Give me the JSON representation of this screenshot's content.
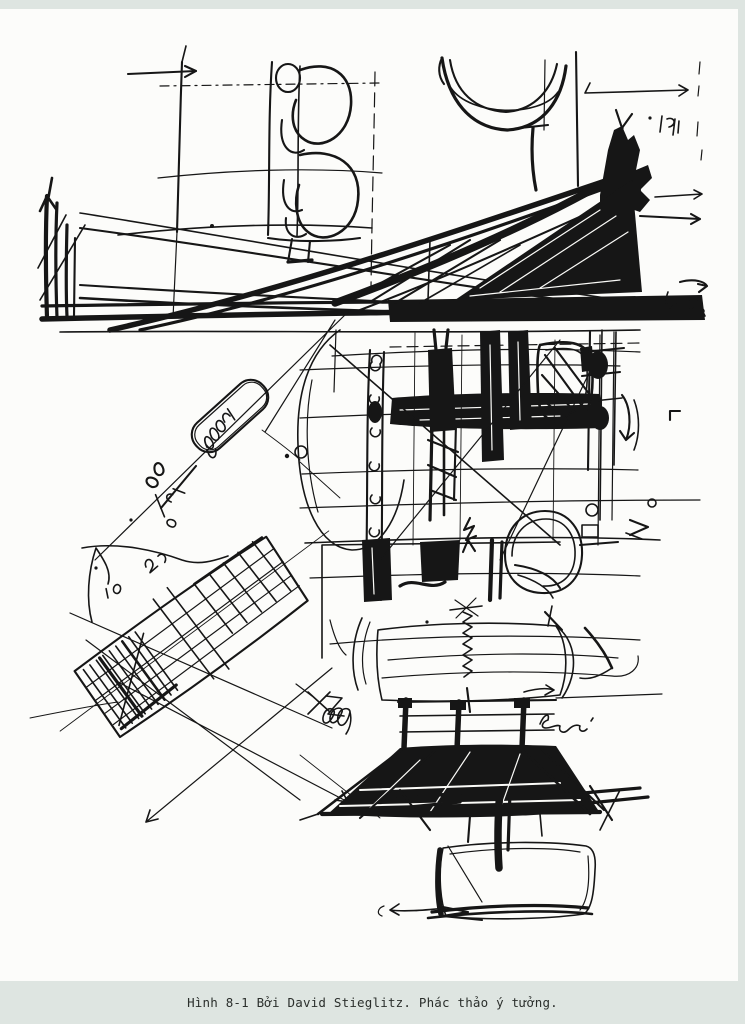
{
  "page": {
    "paper_color": "#fcfcfa",
    "trim_color": "#dee5e1"
  },
  "caption": {
    "text": "Hình 8-1 Bởi David Stieglitz. Phác thảo ý tưởng.",
    "band_color": "#dee5e1",
    "text_color": "#2b2f2c"
  },
  "figure": {
    "description": "Freehand black-ink architectural concept sketch by David Stieglitz: colonnade, catenary roof, long triangular truss, dense gridded building mass, tilted bar building, coil spring over a hatched plinth and a rounded base slab",
    "ink_color": "#161616",
    "handwritten_annotations": [
      {
        "name": "capsule-note",
        "approx_text": "10,000 (cursive scribble inside tilted capsule)"
      },
      {
        "name": "fraction-note",
        "approx_text": "96 8/34 (rotated scribble)"
      },
      {
        "name": "number-note-20",
        "approx_text": "20"
      },
      {
        "name": "number-note-10",
        "approx_text": "10"
      },
      {
        "name": "cursive-note-semi",
        "approx_text": "Semi"
      },
      {
        "name": "cursive-note-gga",
        "approx_text": "gga (cursive loops)"
      },
      {
        "name": "corner-mark",
        "approx_text": "kd (small scribble, top right)"
      }
    ]
  }
}
